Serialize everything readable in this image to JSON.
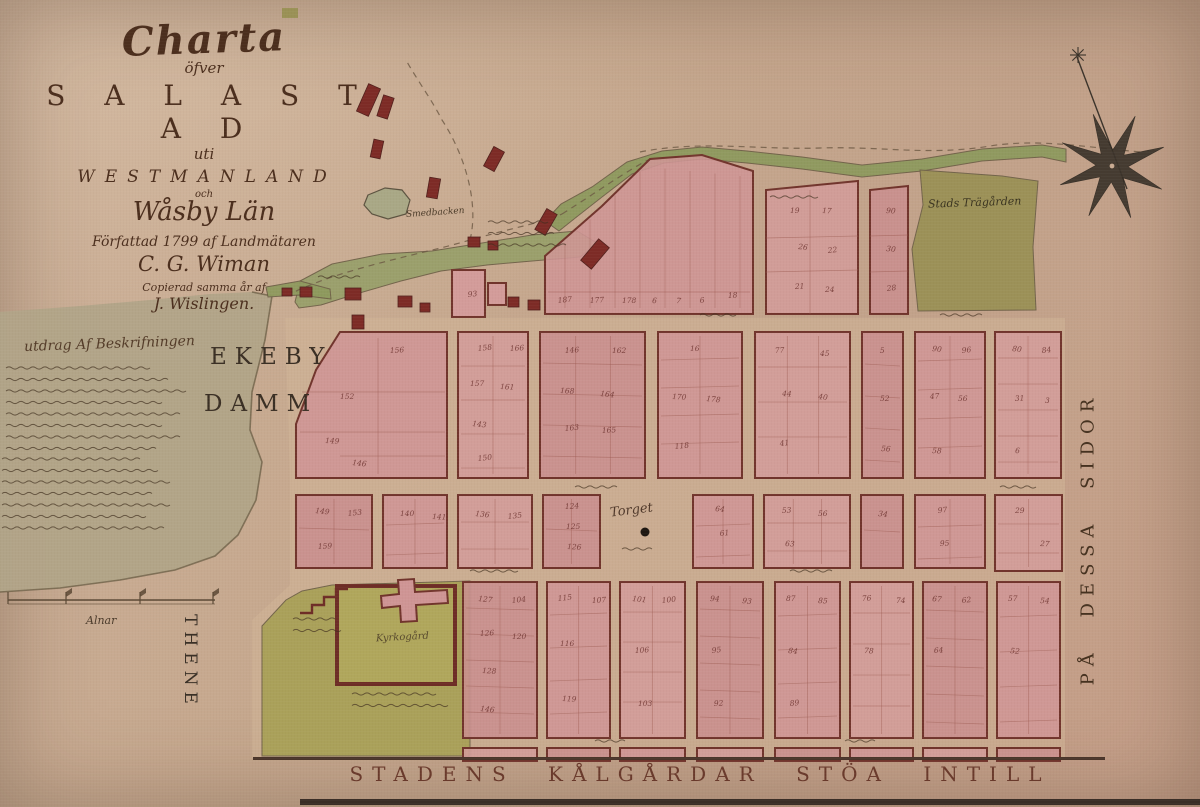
{
  "title_block": {
    "charta": "Charta",
    "ofver": "öfver",
    "sala_stad": "S A L A  S T A D",
    "uti": "uti",
    "westmanland": "WESTMANLAND",
    "och": "och",
    "wasby_lan": "Wåsby Län",
    "line_authored": "Författad 1799 af Landmätaren",
    "author": "C. G. Wiman",
    "line_copied": "Copierad samma år af",
    "copyist": "J. Wislingen."
  },
  "description": {
    "heading": "utdrag Af Beskrifningen"
  },
  "labels": {
    "lake_line1": "EKEBY",
    "lake_line2": "DAMM",
    "town_garden": "Stads Trägården",
    "hill": "Smedbacken",
    "square": "Torget",
    "churchyard": "Kyrkogård",
    "scale_unit": "Alnar",
    "left_vertical": "THENE",
    "right_vertical": "PÅ DESSA SIDOR",
    "bottom_caption": "STADENS KÅLGÅRDAR STÖA INTILL"
  },
  "colors": {
    "parchment": "#c5a78e",
    "lake": "#b1a488",
    "shore": "#6f6148",
    "underlay": "#d2b697",
    "block_fills": [
      "#cf9595",
      "#d39c9a",
      "#c98e8e"
    ],
    "block_stroke": "#71342c",
    "sub_line": "#9b5a50",
    "green_garden": "#9a9156",
    "green_church": "#a9a158",
    "green_meadow": "#99a06b",
    "green_stream": "#8e9a5e",
    "building": "#7d2b26",
    "ink": "#41301f",
    "number": "#6e3430",
    "road": "#6b5742",
    "border": "#4a352a"
  },
  "map": {
    "underlay": "285,318 1065,318 1065,758 252,758 252,620 290,585 290,480",
    "lake": "0,312 80,306 150,300 210,294 252,292 272,296 265,340 252,392 250,430 262,462 256,500 238,535 215,556 175,570 120,580 60,588 0,592",
    "shoreline": "252,292 272,296 265,340 252,392 250,430 262,462 256,500 238,535 215,556 175,570 120,580 60,588 0,592",
    "greens": [
      {
        "name": "meadow",
        "pts": "295,302 300,281 332,264 382,254 432,251 482,243 532,235 577,231 597,243 580,257 532,261 487,265 441,271 401,281 356,294 321,305 299,308",
        "fill": "green_meadow"
      },
      {
        "name": "stream-band",
        "pts": "545,221 561,204 592,187 627,162 662,151 702,147 747,151 802,157 862,165 922,159 982,149 1042,145 1066,149 1066,162 1042,157 982,161 922,171 862,177 802,169 747,163 702,159 664,163 632,174 602,197 574,219 559,231",
        "fill": "green_stream"
      },
      {
        "name": "dam-patch",
        "pts": "266,287 300,281 330,289 331,299 300,295 268,297",
        "fill": "green_stream"
      },
      {
        "name": "town-garden",
        "pts": "920,170 1002,176 1038,181 1033,247 1036,310 918,311 912,249 923,205",
        "fill": "green_garden"
      },
      {
        "name": "church-grounds",
        "pts": "262,626 286,600 302,591 332,585 470,581 470,756 262,756",
        "fill": "green_church"
      }
    ],
    "pond": "368,195 385,188 402,190 410,200 406,214 388,219 372,214 364,205",
    "roads": [
      "M286,296 C340,268 420,255 470,240 C520,226 545,222 562,214",
      "M470,240 C480,200 462,150 442,120 C432,100 417,80 406,60",
      "M562,214 C600,190 625,172 648,160",
      "M640,152 C700,140 760,150 820,148 C880,146 930,156 990,146 C1040,138 1090,148 1142,152"
    ],
    "blocks": [
      {
        "t": "p",
        "pts": "545,314 545,256 602,206 650,159 702,155 753,171 753,314",
        "fan": true,
        "sub": [
          [
            548,
            292,
            750,
            292
          ]
        ]
      },
      {
        "t": "p",
        "pts": "766,314 766,190 858,181 858,314",
        "sub": [
          [
            766,
            238,
            858,
            236
          ],
          [
            766,
            272,
            858,
            270
          ],
          [
            810,
            190,
            810,
            314
          ]
        ]
      },
      {
        "t": "p",
        "pts": "870,314 870,190 908,186 908,314",
        "sub": [
          [
            870,
            236,
            908,
            235
          ],
          [
            870,
            272,
            908,
            271
          ]
        ]
      },
      {
        "t": "p",
        "pts": "340,332 447,332 447,478 296,478 296,424 316,370",
        "sub": [
          [
            302,
            392,
            445,
            392
          ],
          [
            300,
            432,
            445,
            432
          ],
          [
            378,
            338,
            378,
            474
          ],
          [
            340,
            456,
            445,
            456
          ]
        ]
      },
      {
        "t": "r",
        "x": 458,
        "y": 332,
        "w": 70,
        "h": 146
      },
      {
        "t": "r",
        "x": 540,
        "y": 332,
        "w": 105,
        "h": 146
      },
      {
        "t": "r",
        "x": 658,
        "y": 332,
        "w": 84,
        "h": 146
      },
      {
        "t": "r",
        "x": 755,
        "y": 332,
        "w": 95,
        "h": 146
      },
      {
        "t": "r",
        "x": 862,
        "y": 332,
        "w": 41,
        "h": 146
      },
      {
        "t": "r",
        "x": 915,
        "y": 332,
        "w": 70,
        "h": 146
      },
      {
        "t": "r",
        "x": 995,
        "y": 332,
        "w": 66,
        "h": 146
      },
      {
        "t": "r",
        "x": 296,
        "y": 495,
        "w": 76,
        "h": 73
      },
      {
        "t": "r",
        "x": 383,
        "y": 495,
        "w": 64,
        "h": 73
      },
      {
        "t": "r",
        "x": 458,
        "y": 495,
        "w": 74,
        "h": 73
      },
      {
        "t": "r",
        "x": 543,
        "y": 495,
        "w": 57,
        "h": 73
      },
      {
        "t": "r",
        "x": 693,
        "y": 495,
        "w": 60,
        "h": 73
      },
      {
        "t": "r",
        "x": 764,
        "y": 495,
        "w": 86,
        "h": 73
      },
      {
        "t": "r",
        "x": 861,
        "y": 495,
        "w": 42,
        "h": 73
      },
      {
        "t": "r",
        "x": 915,
        "y": 495,
        "w": 70,
        "h": 73
      },
      {
        "t": "r",
        "x": 995,
        "y": 495,
        "w": 67,
        "h": 76
      },
      {
        "t": "r",
        "x": 463,
        "y": 582,
        "w": 74,
        "h": 156
      },
      {
        "t": "r",
        "x": 547,
        "y": 582,
        "w": 63,
        "h": 156
      },
      {
        "t": "r",
        "x": 620,
        "y": 582,
        "w": 65,
        "h": 156
      },
      {
        "t": "r",
        "x": 697,
        "y": 582,
        "w": 66,
        "h": 156
      },
      {
        "t": "r",
        "x": 775,
        "y": 582,
        "w": 65,
        "h": 156
      },
      {
        "t": "r",
        "x": 850,
        "y": 582,
        "w": 63,
        "h": 156
      },
      {
        "t": "r",
        "x": 923,
        "y": 582,
        "w": 64,
        "h": 156
      },
      {
        "t": "r",
        "x": 997,
        "y": 582,
        "w": 63,
        "h": 156
      },
      {
        "t": "r",
        "x": 463,
        "y": 748,
        "w": 74,
        "h": 13
      },
      {
        "t": "r",
        "x": 547,
        "y": 748,
        "w": 63,
        "h": 13
      },
      {
        "t": "r",
        "x": 620,
        "y": 748,
        "w": 65,
        "h": 13
      },
      {
        "t": "r",
        "x": 697,
        "y": 748,
        "w": 66,
        "h": 13
      },
      {
        "t": "r",
        "x": 775,
        "y": 748,
        "w": 65,
        "h": 13
      },
      {
        "t": "r",
        "x": 850,
        "y": 748,
        "w": 63,
        "h": 13
      },
      {
        "t": "r",
        "x": 923,
        "y": 748,
        "w": 64,
        "h": 13
      },
      {
        "t": "r",
        "x": 997,
        "y": 748,
        "w": 63,
        "h": 13
      }
    ],
    "buildings": [
      [
        362,
        85,
        13,
        30,
        24
      ],
      [
        380,
        96,
        11,
        22,
        18
      ],
      [
        372,
        140,
        10,
        18,
        12
      ],
      [
        428,
        178,
        11,
        20,
        10
      ],
      [
        488,
        148,
        12,
        22,
        28
      ],
      [
        540,
        210,
        12,
        24,
        30
      ],
      [
        588,
        240,
        14,
        28,
        40
      ],
      [
        345,
        288,
        16,
        12,
        0
      ],
      [
        300,
        287,
        12,
        10,
        0
      ],
      [
        352,
        315,
        12,
        14,
        0
      ],
      [
        398,
        296,
        14,
        11,
        0
      ],
      [
        420,
        303,
        10,
        9,
        0
      ],
      [
        468,
        237,
        12,
        10,
        0
      ],
      [
        488,
        241,
        10,
        9,
        0
      ],
      [
        508,
        297,
        11,
        10,
        0
      ],
      [
        528,
        300,
        12,
        10,
        0
      ],
      [
        460,
        286,
        10,
        9,
        0
      ],
      [
        282,
        288,
        10,
        8,
        0
      ]
    ],
    "pink_buildings": [
      {
        "x": 452,
        "y": 270,
        "w": 33,
        "h": 47
      },
      {
        "x": 488,
        "y": 283,
        "w": 18,
        "h": 22
      }
    ],
    "church": {
      "yard": {
        "x": 337,
        "y": 586,
        "w": 118,
        "h": 98
      },
      "cross_path": "M381,596 L399,594 L398,580 L414,579 L415,592 L447,590 L448,603 L416,605 L417,621 L401,622 L400,606 L382,608 Z",
      "step_line": "300,613 312,613 312,605 324,605 324,597 336,597 336,589 348,589"
    },
    "compass": {
      "cx": 1112,
      "cy": 166,
      "r1": 55,
      "r2": 16,
      "rot": -20,
      "needle": [
        1077,
        57,
        1127,
        189
      ],
      "asterisk": [
        1078,
        55
      ]
    },
    "scale_bar": {
      "x1": 8,
      "x2": 215,
      "y": 600,
      "ticks": [
        8,
        66,
        140,
        213
      ]
    },
    "torget_dot": [
      645,
      532
    ],
    "border_lines": [
      {
        "x": 253,
        "y": 757,
        "w": 852,
        "h": 3,
        "c": "#4a352a"
      },
      {
        "x": 300,
        "y": 799,
        "w": 900,
        "h": 6,
        "c": "#3a2e26"
      }
    ],
    "deco_marks": [
      {
        "x": 282,
        "y": 8,
        "w": 16,
        "h": 10,
        "c": "#9a9156"
      }
    ],
    "squiggles": [
      {
        "x": 6,
        "y": 368,
        "w": 186,
        "n": 8
      },
      {
        "x": 2,
        "y": 459,
        "w": 176,
        "n": 7
      },
      {
        "x": 488,
        "y": 222,
        "w": 80,
        "n": 3
      },
      {
        "x": 622,
        "y": 549,
        "w": 42,
        "n": 1
      },
      {
        "x": 293,
        "y": 619,
        "w": 55,
        "n": 2
      },
      {
        "x": 352,
        "y": 694,
        "w": 112,
        "n": 2
      },
      {
        "x": 770,
        "y": 197,
        "w": 62,
        "n": 1
      },
      {
        "x": 575,
        "y": 487,
        "w": 55,
        "n": 1
      },
      {
        "x": 470,
        "y": 571,
        "w": 60,
        "n": 1
      },
      {
        "x": 790,
        "y": 571,
        "w": 55,
        "n": 1
      },
      {
        "x": 700,
        "y": 315,
        "w": 50,
        "n": 1
      },
      {
        "x": 940,
        "y": 315,
        "w": 55,
        "n": 1
      },
      {
        "x": 595,
        "y": 741,
        "w": 40,
        "n": 1
      },
      {
        "x": 845,
        "y": 741,
        "w": 40,
        "n": 1
      },
      {
        "x": 1000,
        "y": 487,
        "w": 45,
        "n": 1
      },
      {
        "x": 318,
        "y": 277,
        "w": 55,
        "n": 1
      }
    ],
    "plot_numbers": [
      [
        558,
        303,
        "187"
      ],
      [
        590,
        303,
        "177"
      ],
      [
        622,
        303,
        "178"
      ],
      [
        652,
        303,
        "6"
      ],
      [
        676,
        303,
        "7"
      ],
      [
        700,
        303,
        "6"
      ],
      [
        728,
        298,
        "18"
      ],
      [
        790,
        213,
        "19"
      ],
      [
        822,
        213,
        "17"
      ],
      [
        798,
        249,
        "26"
      ],
      [
        828,
        253,
        "22"
      ],
      [
        795,
        289,
        "21"
      ],
      [
        825,
        292,
        "24"
      ],
      [
        886,
        213,
        "90"
      ],
      [
        886,
        251,
        "30"
      ],
      [
        887,
        291,
        "28"
      ],
      [
        390,
        353,
        "156"
      ],
      [
        340,
        399,
        "152"
      ],
      [
        325,
        443,
        "149"
      ],
      [
        352,
        465,
        "146"
      ],
      [
        478,
        351,
        "158"
      ],
      [
        510,
        351,
        "166"
      ],
      [
        470,
        386,
        "157"
      ],
      [
        500,
        389,
        "161"
      ],
      [
        472,
        426,
        "143"
      ],
      [
        478,
        461,
        "150"
      ],
      [
        565,
        353,
        "146"
      ],
      [
        612,
        353,
        "162"
      ],
      [
        560,
        393,
        "168"
      ],
      [
        600,
        396,
        "164"
      ],
      [
        565,
        431,
        "163"
      ],
      [
        602,
        433,
        "165"
      ],
      [
        690,
        351,
        "16"
      ],
      [
        672,
        399,
        "170"
      ],
      [
        706,
        401,
        "178"
      ],
      [
        675,
        449,
        "118"
      ],
      [
        775,
        353,
        "77"
      ],
      [
        820,
        356,
        "45"
      ],
      [
        782,
        396,
        "44"
      ],
      [
        818,
        399,
        "40"
      ],
      [
        780,
        446,
        "41"
      ],
      [
        880,
        353,
        "5"
      ],
      [
        880,
        401,
        "52"
      ],
      [
        881,
        451,
        "56"
      ],
      [
        932,
        351,
        "90"
      ],
      [
        962,
        353,
        "96"
      ],
      [
        930,
        399,
        "47"
      ],
      [
        958,
        401,
        "56"
      ],
      [
        932,
        453,
        "58"
      ],
      [
        1012,
        351,
        "80"
      ],
      [
        1042,
        353,
        "84"
      ],
      [
        1015,
        401,
        "31"
      ],
      [
        1045,
        403,
        "3"
      ],
      [
        1015,
        453,
        "6"
      ],
      [
        315,
        513,
        "149"
      ],
      [
        348,
        516,
        "153"
      ],
      [
        318,
        549,
        "159"
      ],
      [
        400,
        516,
        "140"
      ],
      [
        432,
        519,
        "141"
      ],
      [
        475,
        516,
        "136"
      ],
      [
        508,
        519,
        "135"
      ],
      [
        565,
        509,
        "124"
      ],
      [
        566,
        529,
        "125"
      ],
      [
        567,
        549,
        "126"
      ],
      [
        715,
        511,
        "64"
      ],
      [
        720,
        536,
        "61"
      ],
      [
        782,
        513,
        "53"
      ],
      [
        818,
        516,
        "56"
      ],
      [
        785,
        546,
        "63"
      ],
      [
        878,
        516,
        "34"
      ],
      [
        938,
        513,
        "97"
      ],
      [
        940,
        546,
        "95"
      ],
      [
        1015,
        513,
        "29"
      ],
      [
        1040,
        546,
        "27"
      ],
      [
        478,
        601,
        "127"
      ],
      [
        512,
        603,
        "104"
      ],
      [
        480,
        636,
        "126"
      ],
      [
        512,
        639,
        "120"
      ],
      [
        482,
        673,
        "128"
      ],
      [
        480,
        711,
        "146"
      ],
      [
        558,
        601,
        "115"
      ],
      [
        592,
        603,
        "107"
      ],
      [
        560,
        646,
        "116"
      ],
      [
        562,
        701,
        "119"
      ],
      [
        632,
        601,
        "101"
      ],
      [
        662,
        603,
        "100"
      ],
      [
        635,
        653,
        "106"
      ],
      [
        638,
        706,
        "103"
      ],
      [
        710,
        601,
        "94"
      ],
      [
        742,
        603,
        "93"
      ],
      [
        712,
        653,
        "95"
      ],
      [
        714,
        706,
        "92"
      ],
      [
        786,
        601,
        "87"
      ],
      [
        818,
        603,
        "85"
      ],
      [
        788,
        653,
        "84"
      ],
      [
        790,
        706,
        "89"
      ],
      [
        862,
        601,
        "76"
      ],
      [
        896,
        603,
        "74"
      ],
      [
        864,
        653,
        "78"
      ],
      [
        932,
        601,
        "67"
      ],
      [
        962,
        603,
        "62"
      ],
      [
        934,
        653,
        "64"
      ],
      [
        1008,
        601,
        "57"
      ],
      [
        1040,
        603,
        "54"
      ],
      [
        1010,
        653,
        "52"
      ],
      [
        468,
        297,
        "93"
      ]
    ]
  }
}
